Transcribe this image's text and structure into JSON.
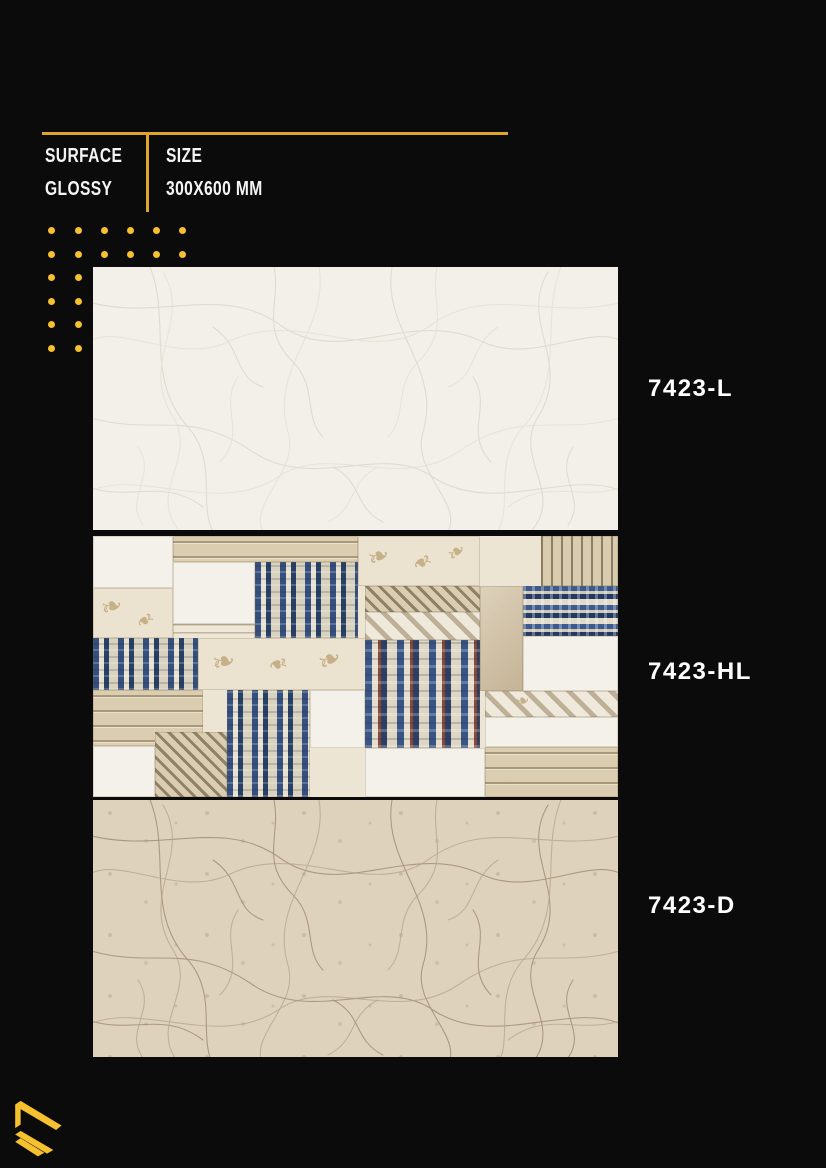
{
  "header": {
    "surface_label": "SURFACE",
    "surface_value": "GLOSSY",
    "size_label": "SIZE",
    "size_value": "300X600 MM"
  },
  "products": [
    {
      "code": "7423-L"
    },
    {
      "code": "7423-HL"
    },
    {
      "code": "7423-D"
    }
  ],
  "decor": {
    "ornament_glyph": "❧"
  },
  "icons": {
    "logo": "brand-chevron-logo",
    "ornament": "damask-flourish"
  },
  "colors": {
    "background": "#0B0B0B",
    "accent": "#DFA62B",
    "accent_dots": "#F6C12F",
    "header_text": "#F4F4F4",
    "label_text": "#FFFFFF",
    "tile_light": "#F3F0E9",
    "tile_dark": "#DED2BD",
    "hl_base": "#ECE5D4"
  }
}
